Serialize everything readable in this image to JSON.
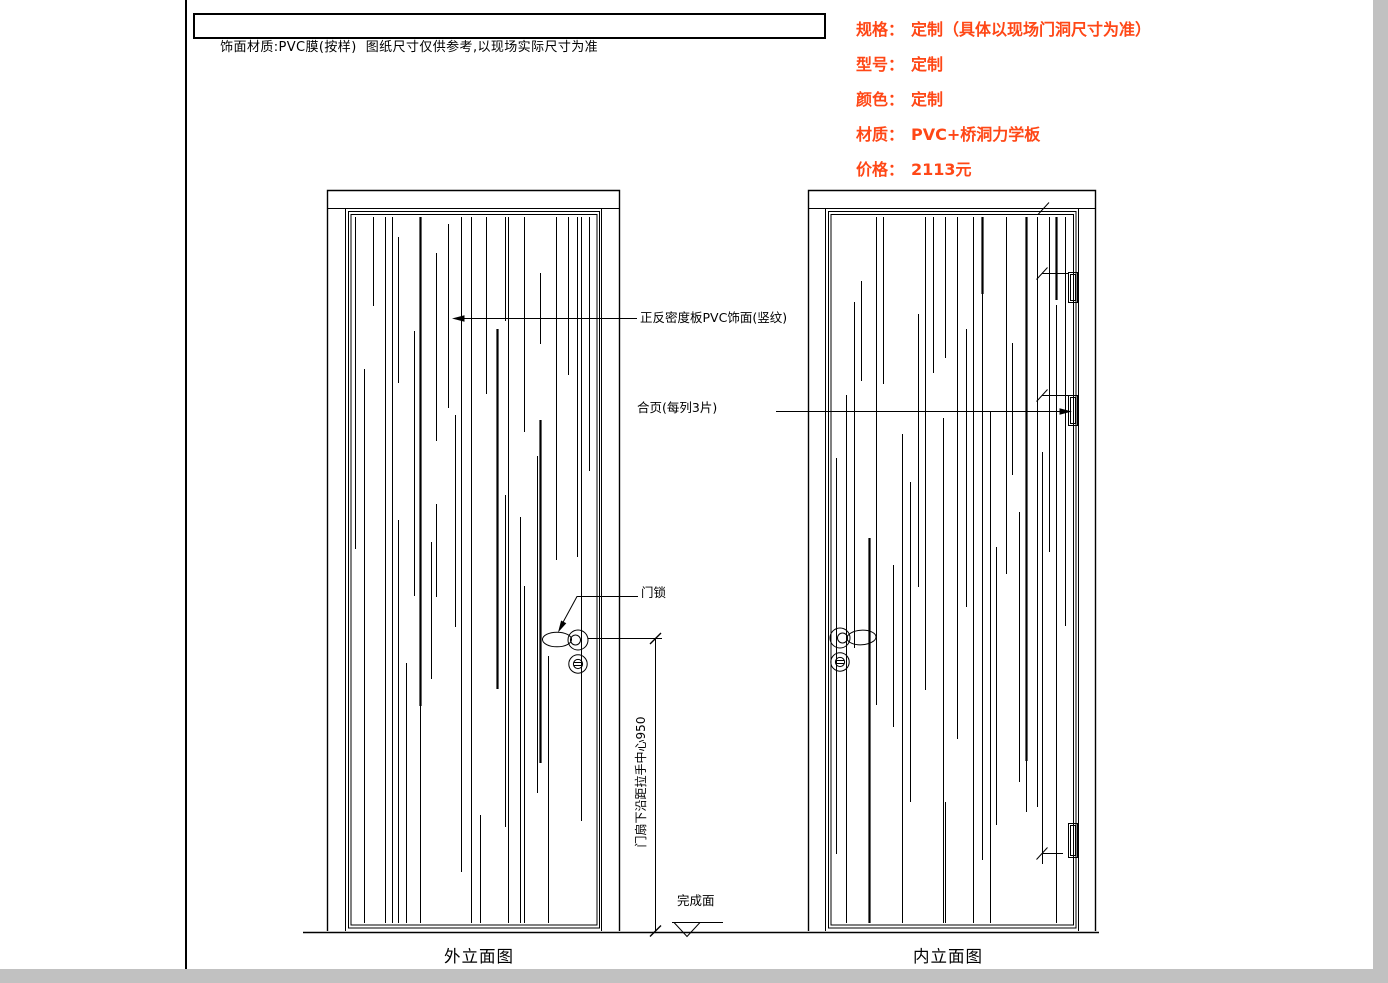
{
  "header": {
    "note": "饰面材质:PVC膜(按样)  图纸尺寸仅供参考,以现场实际尺寸为准"
  },
  "specs": {
    "items": [
      {
        "label": "规格：",
        "value": "定制（具体以现场门洞尺寸为准）"
      },
      {
        "label": "型号：",
        "value": "定制"
      },
      {
        "label": "颜色：",
        "value": "定制"
      },
      {
        "label": "材质：",
        "value": "PVC+桥洞力学板"
      },
      {
        "label": "价格：",
        "value": "2113元"
      }
    ]
  },
  "annotations": {
    "surface": "正反密度板PVC饰面(竖纹)",
    "hinges": "合页(每列3片)",
    "lock": "门锁",
    "handle_height": "门扇下沿距拉手中心950",
    "finish_level": "完成面"
  },
  "views": {
    "left_label": "外立面图",
    "right_label": "内立面图"
  },
  "colors": {
    "accent": "#ff4716",
    "line": "#000000",
    "page_margin": "#c1c1c1"
  }
}
